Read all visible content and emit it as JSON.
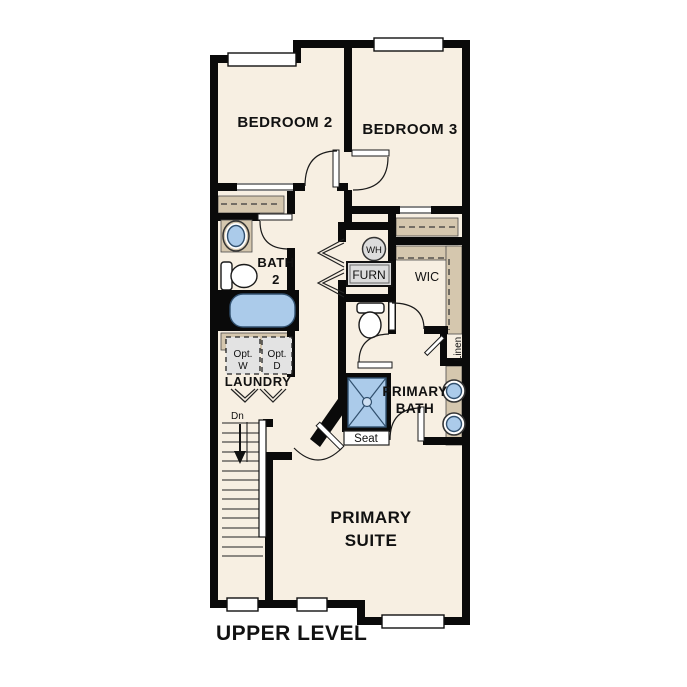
{
  "plan": {
    "title": "UPPER LEVEL",
    "level": "Upper Level floor plan",
    "rooms": {
      "bedroom2": "BEDROOM 2",
      "bedroom3": "BEDROOM 3",
      "bath2": {
        "line1": "BATH",
        "line2": "2"
      },
      "wic": "WIC",
      "laundry": "LAUNDRY",
      "primary_bath": {
        "line1": "PRIMARY",
        "line2": "BATH"
      },
      "primary_suite": {
        "line1": "PRIMARY",
        "line2": "SUITE"
      }
    },
    "fixtures": {
      "wh": "WH",
      "furn": "FURN",
      "linen": "Linen",
      "seat": "Seat",
      "dn": "Dn",
      "opt_w": {
        "line1": "Opt.",
        "line2": "W"
      },
      "opt_d": {
        "line1": "Opt.",
        "line2": "D"
      }
    },
    "colors": {
      "floor": "#f7efe2",
      "wall": "#0a0a0a",
      "fixture_blue": "#abcbea",
      "shelf_tan": "#d5c7ae",
      "appliance_gray": "#dcdcdc",
      "background": "#ffffff"
    }
  }
}
